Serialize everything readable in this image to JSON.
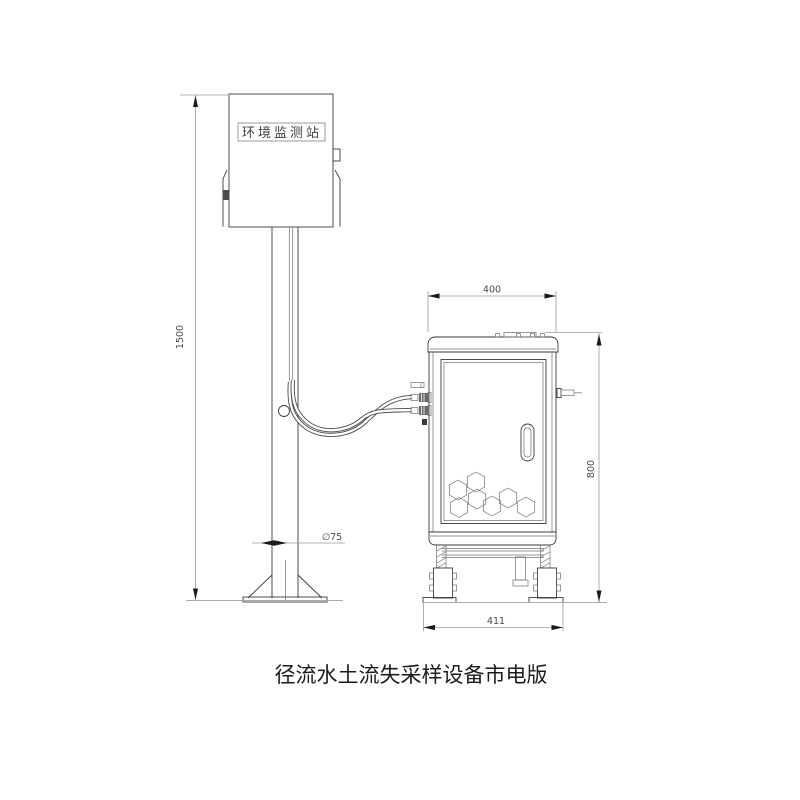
{
  "drawing": {
    "caption": "径流水土流失采样设备市电版",
    "station_label": "环境监测站",
    "dimensions": {
      "pole_height": "1500",
      "pole_diameter": "∅75",
      "cabinet_width": "400",
      "cabinet_height": "800",
      "base_width": "411"
    },
    "colors": {
      "line": "#3a3a3a",
      "dimension_line": "#9b9b9b",
      "dimension_text": "#4a4a4a",
      "caption_text": "#1c1c1c",
      "background": "#ffffff"
    },
    "icons": {
      "honeycomb": "hexagon-pattern",
      "handle": "door-handle"
    }
  }
}
